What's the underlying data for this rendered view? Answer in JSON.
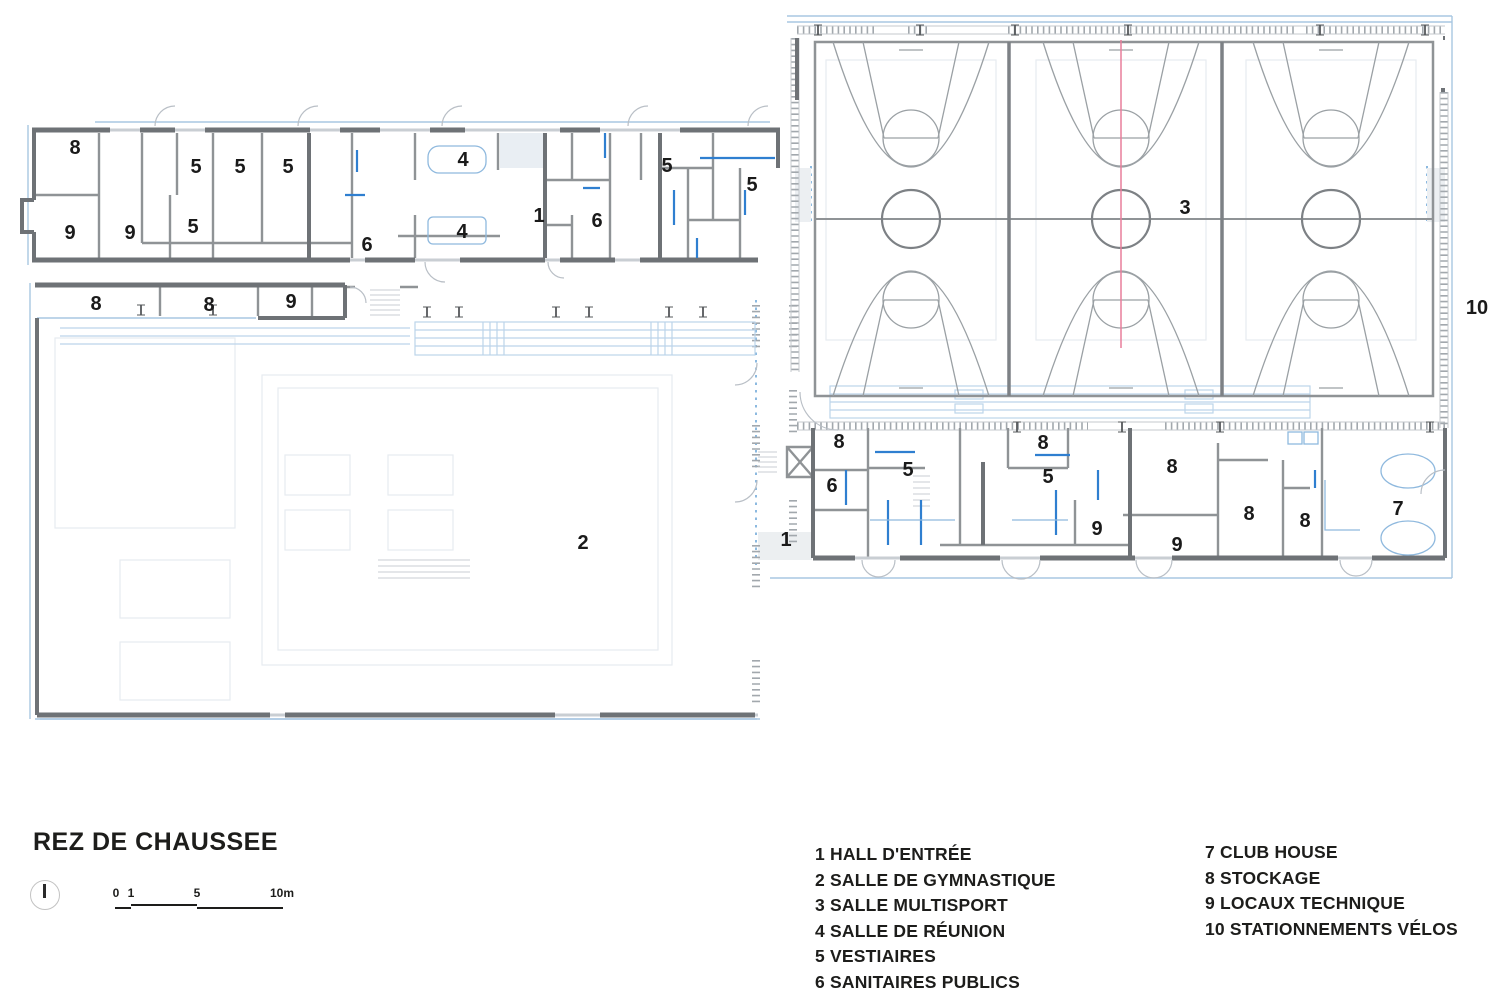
{
  "title": "REZ DE CHAUSSEE",
  "scale": [
    "0",
    "1",
    "5",
    "10m"
  ],
  "legend": {
    "column1": [
      "1 HALL D'ENTRÉE",
      "2 SALLE DE GYMNASTIQUE",
      "3 SALLE MULTISPORT",
      "4 SALLE DE RÉUNION",
      "5 VESTIAIRES",
      "6 SANITAIRES PUBLICS"
    ],
    "column2": [
      "7 CLUB HOUSE",
      "8 STOCKAGE",
      "9 LOCAUX TECHNIQUE",
      "10 STATIONNEMENTS VÉLOS"
    ]
  },
  "rooms": {
    "labels": [
      "8",
      "5",
      "5",
      "5",
      "4",
      "9",
      "9",
      "5",
      "6",
      "4",
      "1",
      "6",
      "5",
      "5",
      "8",
      "8",
      "9",
      "2",
      "3",
      "10",
      "8",
      "6",
      "5",
      "1",
      "8",
      "5",
      "9",
      "8",
      "9",
      "8",
      "8",
      "7"
    ]
  },
  "colors": {
    "wall_dark": "#6e7276",
    "wall_mid": "#8f9396",
    "exterior_blue": "#a9c7e2",
    "partition_blue": "#2f7fd0",
    "axis_red": "#e87f9b",
    "court_line": "#9aa0a4",
    "text": "#1d1d1b"
  }
}
